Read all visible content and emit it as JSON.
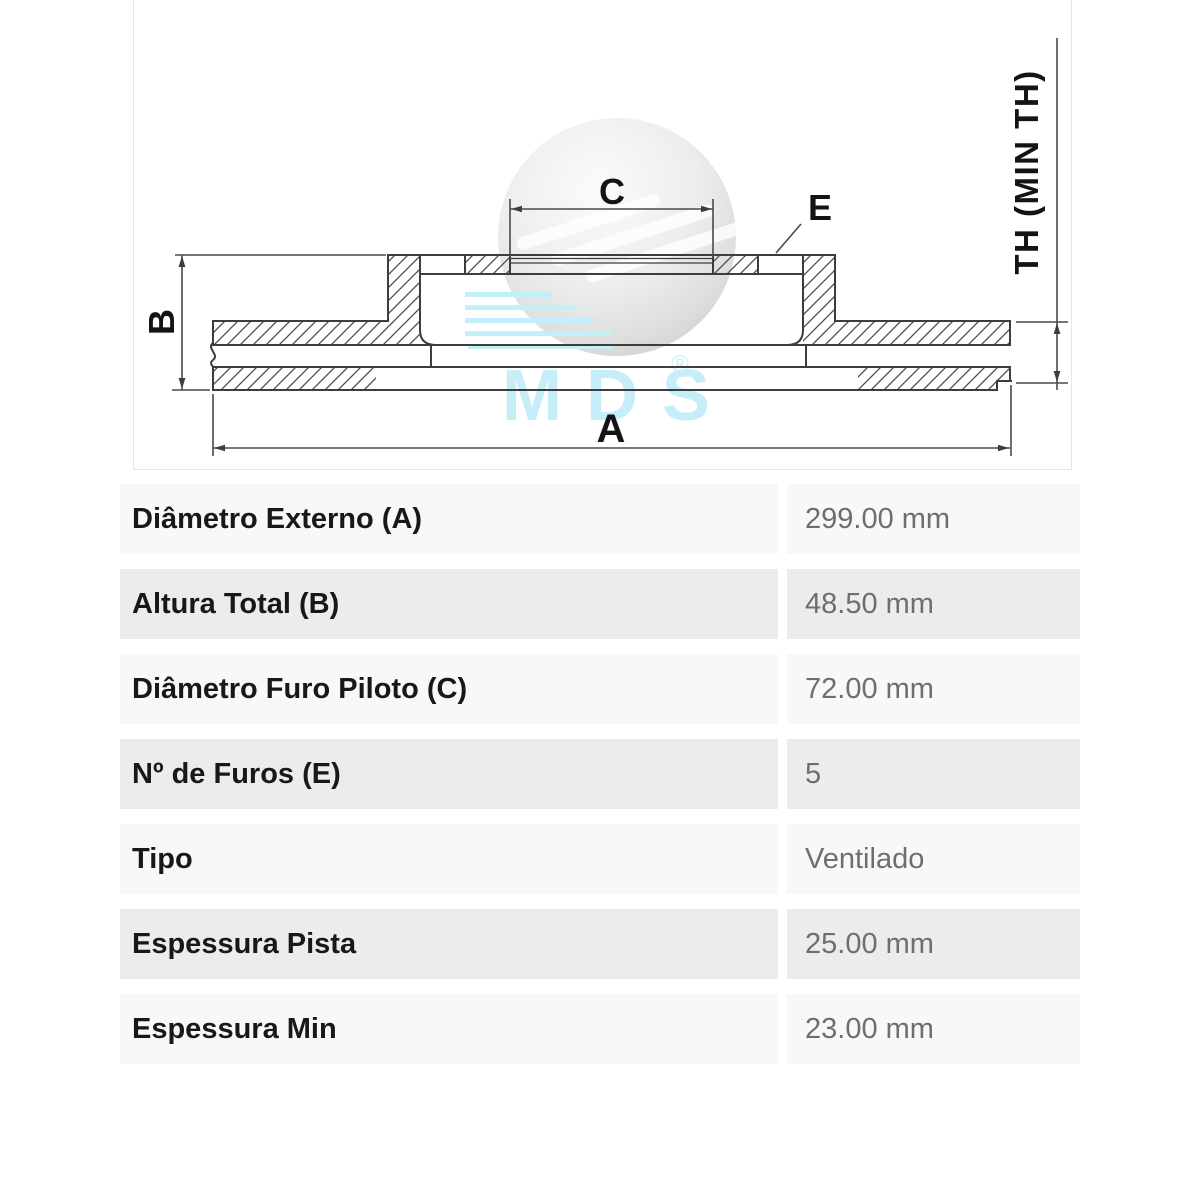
{
  "diagram": {
    "dim_a": "A",
    "dim_b": "B",
    "dim_c": "C",
    "dim_e": "E",
    "dim_th": "TH (MIN TH)"
  },
  "watermark": {
    "brand": "MDS",
    "registered": "®"
  },
  "table": {
    "rows": [
      {
        "label": "Diâmetro Externo (A)",
        "value": "299.00 mm"
      },
      {
        "label": "Altura Total (B)",
        "value": "48.50 mm"
      },
      {
        "label": "Diâmetro Furo Piloto (C)",
        "value": "72.00 mm"
      },
      {
        "label": "Nº de Furos (E)",
        "value": "5"
      },
      {
        "label": "Tipo",
        "value": "Ventilado"
      },
      {
        "label": "Espessura Pista",
        "value": "25.00 mm"
      },
      {
        "label": "Espessura Min",
        "value": "23.00 mm"
      }
    ]
  },
  "colors": {
    "drawing_line": "#3d3d3d",
    "watermark_cyan": "#c5eef8",
    "sphere_gray": "#dcdcdc",
    "row_light": "#f8f8f8",
    "row_dark": "#ececec",
    "label_text": "#17181a",
    "value_text": "#6b6f74"
  }
}
